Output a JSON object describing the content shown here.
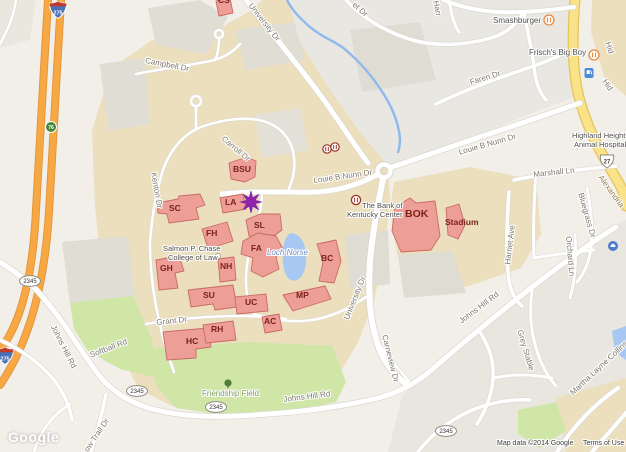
{
  "map": {
    "buildings": {
      "cs": "CS",
      "bsu": "BSU",
      "sc": "SC",
      "la": "LA",
      "fh": "FH",
      "sl": "SL",
      "fa": "FA",
      "nh": "NH",
      "gh": "GH",
      "su": "SU",
      "uc": "UC",
      "mp": "MP",
      "bc": "BC",
      "ac": "AC",
      "hc": "HC",
      "rh": "RH",
      "bok": "BOK",
      "stadium": "Stadium"
    },
    "places": {
      "smashburger": "Smashburger",
      "frischs_big_boy": "Frisch's Big Boy",
      "bank_of_kentucky_line1": "The Bank of",
      "bank_of_kentucky_line2": "Kentucky Center",
      "chase_law_line1": "Salmon P. Chase",
      "chase_law_line2": "College of Law",
      "animal_hospital_line1": "Highland Heights",
      "animal_hospital_line2": "Animal Hospital",
      "friendship_field": "Friendship Field",
      "loch_norse": "Loch Norse"
    },
    "roads": {
      "university_dr": "University Dr",
      "campbell_dr": "Campbell Dr",
      "carroll_dr": "Carroll Dr",
      "kenton_dr": "Kenton Dr",
      "louie_b_nunn_dr": "Louie B Nunn Dr",
      "faren_dr": "Faren Dr",
      "marshall_ln": "Marshall Ln",
      "harriet_ave": "Harriet Ave",
      "bluegrass_dr": "Bluegrass Dr",
      "orchard_ln": "Orchard Ln",
      "johns_hill_rd": "Johns Hill Rd",
      "softball_rd": "Softball Rd",
      "grant_dr": "Grant Dr",
      "grey_stable": "Grey Stable",
      "martha_layne_collins": "Martha Layne Collins",
      "alexandria_pike": "Alexandria",
      "carneview_dr": "Carneview Dr",
      "trail_dr_fragment": "ow Trail Dr",
      "et_dr_fragment": "et Dr",
      "harr_fragment": "Harr",
      "hid_fragment": "Hid"
    },
    "shields": {
      "i275": "275",
      "exit_76": "76",
      "ky_2345": "2345",
      "us_27": "27"
    },
    "attribution": {
      "logo": "Google",
      "map_data": "Map data ©2014 Google",
      "terms": "Terms of Use"
    },
    "colors": {
      "building_fill": "#ec9e97",
      "building_stroke": "#c96b63",
      "highway_orange": "#f7a843",
      "route_yellow": "#f9e287",
      "water": "#a7c8f2",
      "campus_tan": "#ebdfbd",
      "green": "#cfe6a6",
      "marker_purple": "#8e24aa"
    }
  }
}
